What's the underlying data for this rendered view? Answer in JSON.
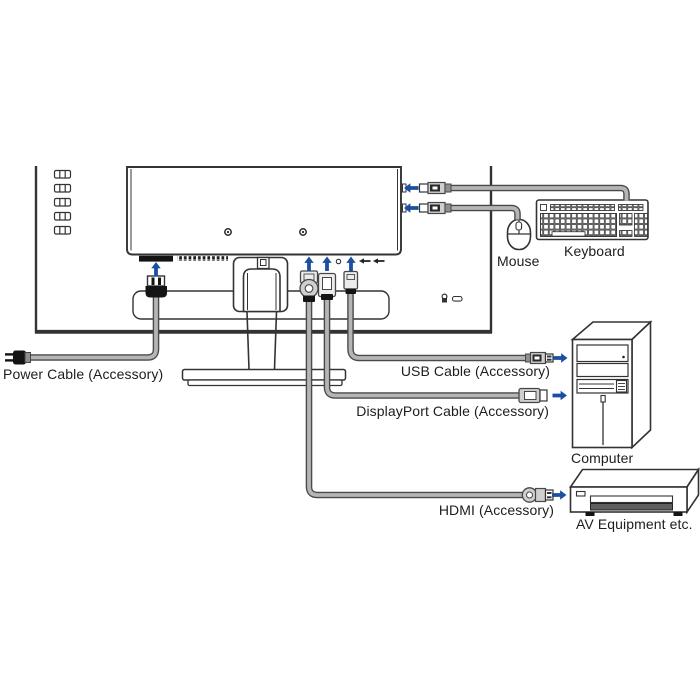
{
  "diagram_title": "Monitor cable connection diagram",
  "labels": {
    "power_cable": "Power Cable (Accessory)",
    "usb_cable": "USB Cable (Accessory)",
    "displayport_cable": "DisplayPort Cable (Accessory)",
    "hdmi": "HDMI (Accessory)",
    "mouse": "Mouse",
    "keyboard": "Keyboard",
    "computer": "Computer",
    "av_equipment": "AV Equipment etc."
  },
  "icons": {
    "connect-arrow-icon": "➜",
    "lock-icon": "🔒",
    "audio-port-icon": "○"
  },
  "colors": {
    "arrow": "#1d4fa0",
    "line": "#333333",
    "cable-edge": "#4a4a4a",
    "cable-fill": "#b5b5b5",
    "dark": "#141414",
    "tray": "#5f5f5f",
    "text": "#1d1d1d"
  }
}
